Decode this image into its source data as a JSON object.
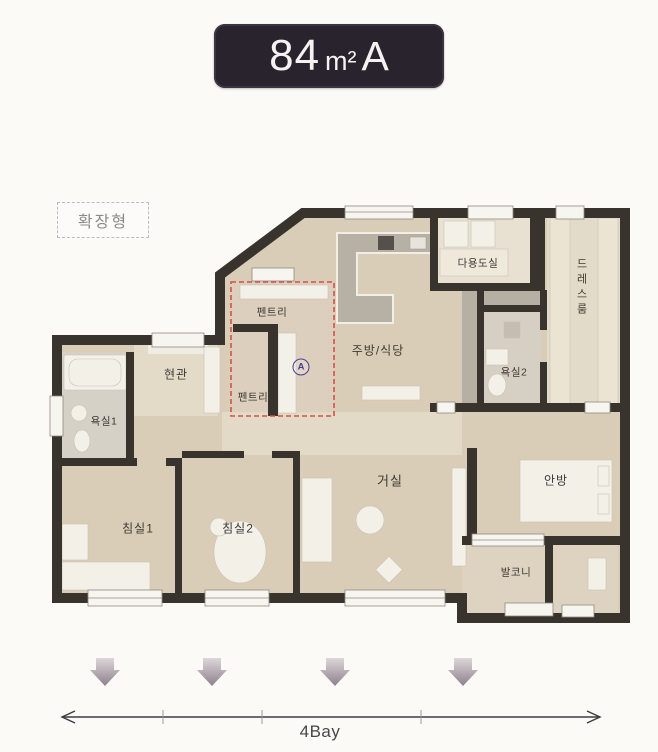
{
  "badge": {
    "area": "84",
    "unit": "m²",
    "type_letter": "A"
  },
  "plan_option": {
    "label": "확장형"
  },
  "rooms": {
    "pantry_top": "펜트리",
    "pantry_bottom": "펜트리",
    "entrance": "현관",
    "bath1": "욕실1",
    "bedroom1": "침실1",
    "bedroom2": "침실2",
    "kitchen": "주방/식당",
    "utility": "다용도실",
    "dressroom": "드레스룸",
    "bath2": "욕실2",
    "living": "거실",
    "master": "안방",
    "balcony": "발코니"
  },
  "marker": {
    "label": "A"
  },
  "annotation": {
    "bay_label": "4Bay"
  },
  "colors": {
    "badge_bg": "#29232e",
    "wall": "#39332d",
    "floor": "#d9cdb8",
    "hall_floor": "#e2d9c6",
    "counter_gray": "#b7b1a5",
    "accent_red": "#d6504a",
    "marker_purple": "#4b3e8e",
    "arrow_mauve": "#8e7f8c"
  }
}
